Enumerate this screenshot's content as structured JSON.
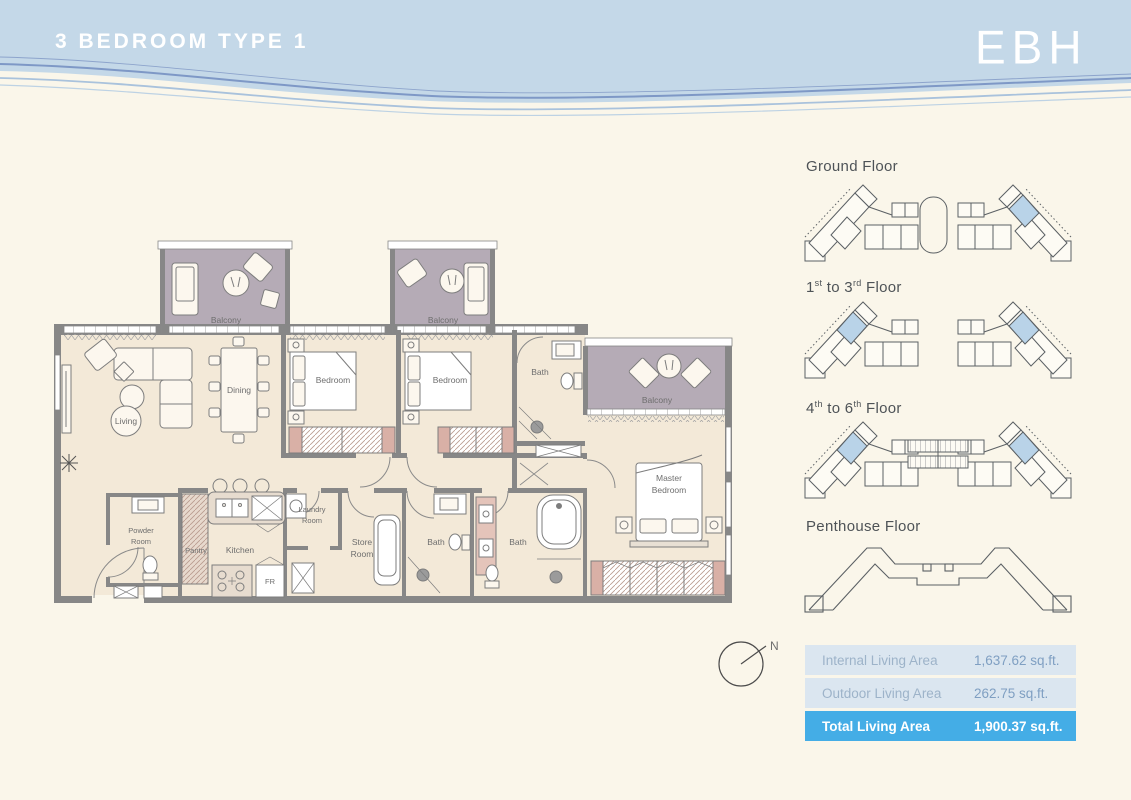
{
  "header": {
    "title": "3 BEDROOM TYPE 1",
    "logo": "EBH"
  },
  "plan": {
    "balcony": "Balcony",
    "living": "Living",
    "dining": "Dining",
    "bedroom": "Bedroom",
    "master_line1": "Master",
    "master_line2": "Bedroom",
    "bath": "Bath",
    "powder_line1": "Powder",
    "powder_line2": "Room",
    "pantry": "Pantry",
    "kitchen": "Kitchen",
    "fr": "FR",
    "laundry_line1": "Laundry",
    "laundry_line2": "Room",
    "store_line1": "Store",
    "store_line2": "Room",
    "compass_n": "N"
  },
  "key_plans": {
    "ground": {
      "label": "Ground Floor"
    },
    "f1_3": {
      "p1": "1",
      "s1": "st",
      "p2": " to 3",
      "s2": "rd",
      "p3": " Floor"
    },
    "f4_6": {
      "p1": "4",
      "s1": "th",
      "p2": " to 6",
      "s2": "th",
      "p3": " Floor"
    },
    "penthouse": {
      "label": "Penthouse Floor"
    }
  },
  "area_table": {
    "rows": [
      {
        "label": "Internal Living Area",
        "value": "1,637.62 sq.ft."
      },
      {
        "label": "Outdoor Living Area",
        "value": "262.75 sq.ft."
      },
      {
        "label": "Total Living Area",
        "value": "1,900.37 sq.ft."
      }
    ]
  },
  "colors": {
    "header_blue": "#c4d8e8",
    "accent_blue": "#44ade6",
    "table_row_blue": "#dbe6f0",
    "highlight_blue": "#b9d3e8",
    "balcony_floor": "#b5abb6",
    "interior_floor": "#f3e9d8",
    "wall_gray": "#878787"
  }
}
